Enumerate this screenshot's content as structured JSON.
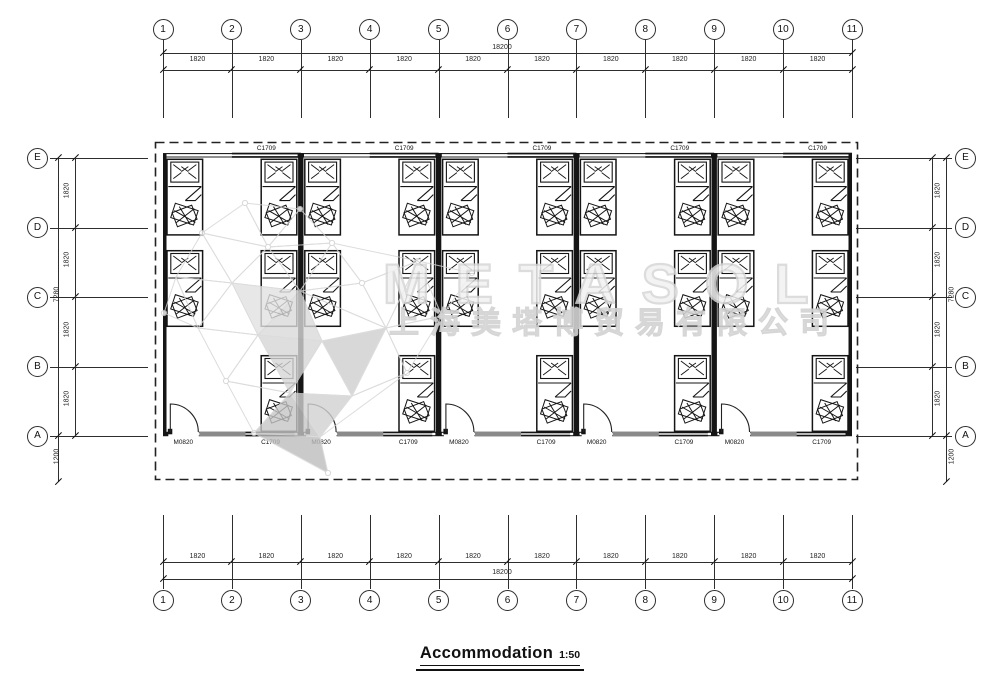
{
  "drawing": {
    "title": "Accommodation",
    "scale": "1:50"
  },
  "watermark": {
    "brand": "METASOL",
    "company": "上海美塔博贸易有限公司"
  },
  "grid": {
    "columns": [
      "1",
      "2",
      "3",
      "4",
      "5",
      "6",
      "7",
      "8",
      "9",
      "10",
      "11"
    ],
    "rows": [
      "E",
      "D",
      "C",
      "B",
      "A"
    ],
    "column_spacing": "1820",
    "column_total": "18200",
    "row_spacing": "1820",
    "row_total": "7280",
    "front_overhang": "1200"
  },
  "openings": {
    "window_label": "C1709",
    "door_label": "M0820"
  },
  "plan_summary": {
    "rooms": 5,
    "beds": 25,
    "doors": 5,
    "top_windows": 5,
    "bottom_windows": 5
  }
}
